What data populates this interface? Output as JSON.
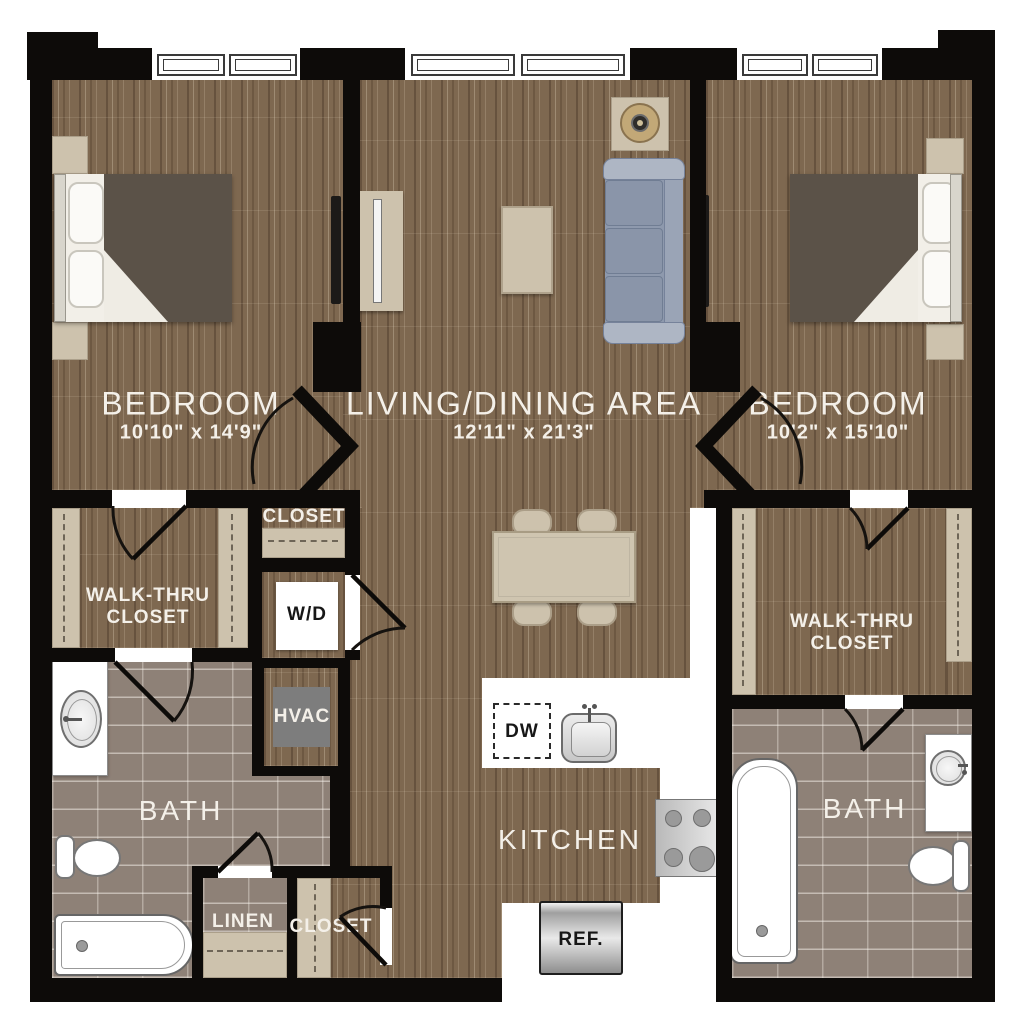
{
  "floorplan": {
    "rooms": {
      "bedroom_left": {
        "label": "BEDROOM",
        "dims": "10'10\" x 14'9\""
      },
      "living_dining": {
        "label": "LIVING/DINING AREA",
        "dims": "12'11\" x 21'3\""
      },
      "bedroom_right": {
        "label": "BEDROOM",
        "dims": "10'2\" x 15'10\""
      },
      "walk_thru_closet_left": {
        "label": "WALK-THRU CLOSET"
      },
      "walk_thru_closet_right": {
        "label": "WALK-THRU CLOSET"
      },
      "closet_upper": {
        "label": "CLOSET"
      },
      "closet_lower": {
        "label": "CLOSET"
      },
      "linen": {
        "label": "LINEN"
      },
      "bath_left": {
        "label": "BATH"
      },
      "bath_right": {
        "label": "BATH"
      },
      "kitchen": {
        "label": "KITCHEN"
      }
    },
    "appliances": {
      "washer_dryer": "W/D",
      "hvac": "HVAC",
      "dishwasher": "DW",
      "refrigerator": "REF."
    },
    "colors": {
      "wall": "#0d0b09",
      "wood_floor": "#7e6850",
      "tile_floor": "#8e8177",
      "shelf_tan": "#cdc2ad",
      "sofa_blue_gray": "#8e99ad",
      "bed_blanket": "#5b5248",
      "hvac_gray": "#7d7d7d",
      "label_text": "#f4f0e9"
    }
  }
}
